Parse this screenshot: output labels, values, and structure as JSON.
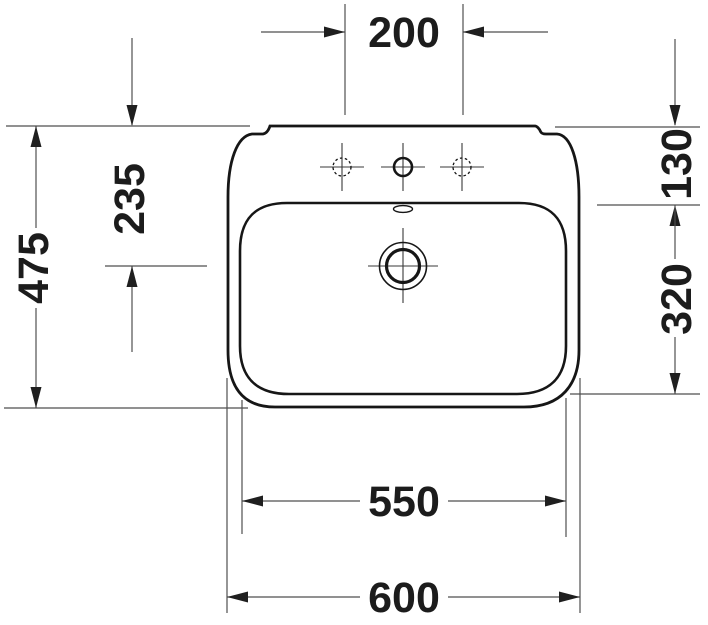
{
  "drawing": {
    "title": "Washbasin technical drawing - top view",
    "units": "mm",
    "labels": {
      "tap_spacing": "200",
      "overall_depth": "475",
      "drain_from_back": "235",
      "back_deck": "130",
      "bowl_depth": "320",
      "bowl_width": "550",
      "overall_width": "600"
    },
    "features": {
      "tap_holes": "3 (center drilled, sides optional dashed)",
      "drain": "center waste with concentric circles",
      "overflow": "slot at rear center of bowl"
    },
    "colors": {
      "background": "#ffffff",
      "outline": "#161616",
      "dimension_line": "#4f4f4f",
      "label_text": "#1c1c1c"
    }
  }
}
